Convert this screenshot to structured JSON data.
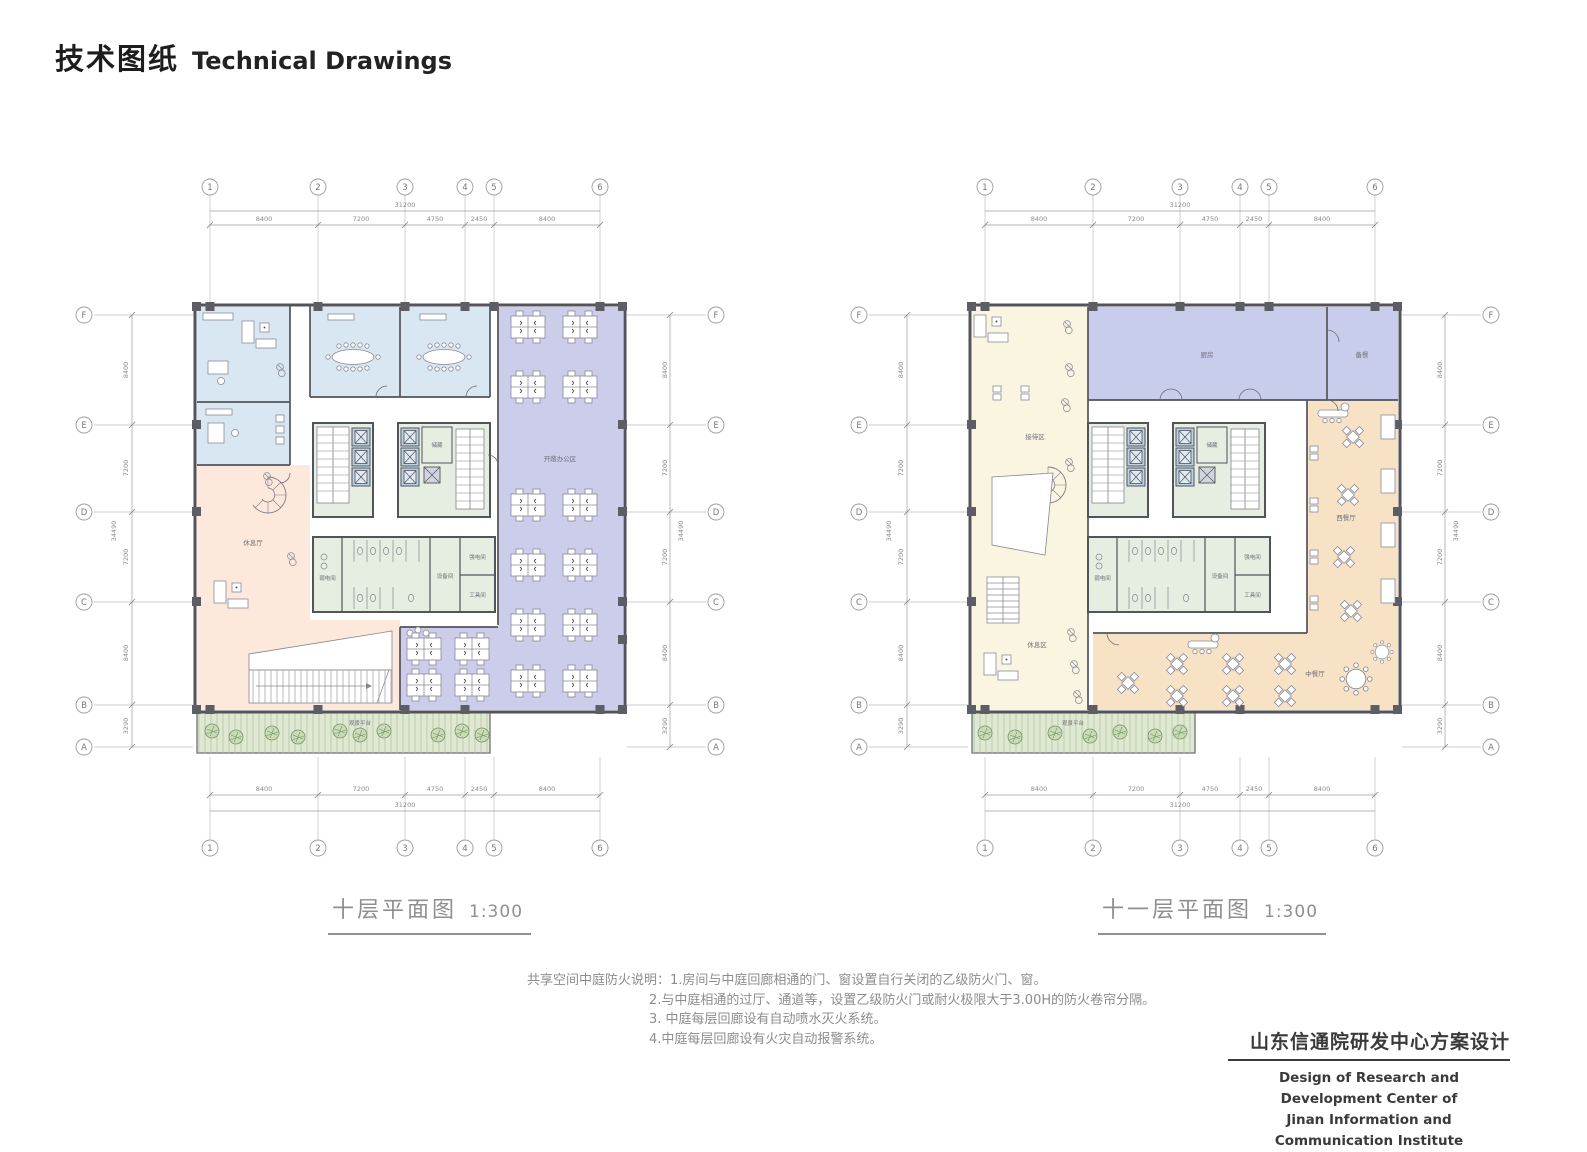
{
  "header": {
    "title_zh": "技术图纸",
    "title_en": "Technical Drawings"
  },
  "grid": {
    "cols": [
      "1",
      "2",
      "3",
      "4",
      "5",
      "6"
    ],
    "rows": [
      "F",
      "E",
      "D",
      "C",
      "B",
      "A"
    ],
    "col_dims": [
      "8400",
      "7200",
      "4750",
      "2450",
      "8400"
    ],
    "col_total": "31200",
    "row_dims": [
      "8400",
      "7200",
      "7200",
      "8400",
      "3290"
    ],
    "row_total": "34490"
  },
  "core_rooms": {
    "storage": "储藏",
    "weak_power": "弱电间",
    "equipment": "设备间",
    "strong_power": "强电间",
    "tool": "工具间",
    "terrace": "观景平台"
  },
  "plans": [
    {
      "name": "十层平面图",
      "scale": "1:300",
      "rooms": {
        "lounge_hall": "休息厅",
        "open_office": "开敞办公区"
      }
    },
    {
      "name": "十一层平面图",
      "scale": "1:300",
      "rooms": {
        "reception": "接待区",
        "kitchen": "厨房",
        "pantry": "备餐",
        "lounge": "休息区",
        "western_restaurant": "西餐厅",
        "chinese_restaurant": "中餐厅"
      }
    }
  ],
  "notes": {
    "prefix": "共享空间中庭防火说明：",
    "lines": [
      "1.房间与中庭回廊相通的门、窗设置自行关闭的乙级防火门、窗。",
      "2.与中庭相通的过厅、通道等，设置乙级防火门或耐火极限大于3.00H的防火卷帘分隔。",
      "3. 中庭每层回廊设有自动喷水灭火系统。",
      "4.中庭每层回廊设有火灾自动报警系统。"
    ]
  },
  "footer": {
    "title_zh": "山东信通院研发中心方案设计",
    "en_line1": "Design of Research and Development Center of",
    "en_line2": "Jinan Information and Communication Institute"
  },
  "colors": {
    "office_blue": "#d9e7f3",
    "open_office_lavender": "#cbcdeb",
    "lounge_peach": "#fce9db",
    "reception_cream": "#f9f5e1",
    "kitchen_purple": "#c9cdec",
    "restaurant_orange": "#f8e2c5",
    "core_green": "#e5eee0",
    "terrace_green": "#dfe9d2",
    "wall": "#53535b"
  }
}
